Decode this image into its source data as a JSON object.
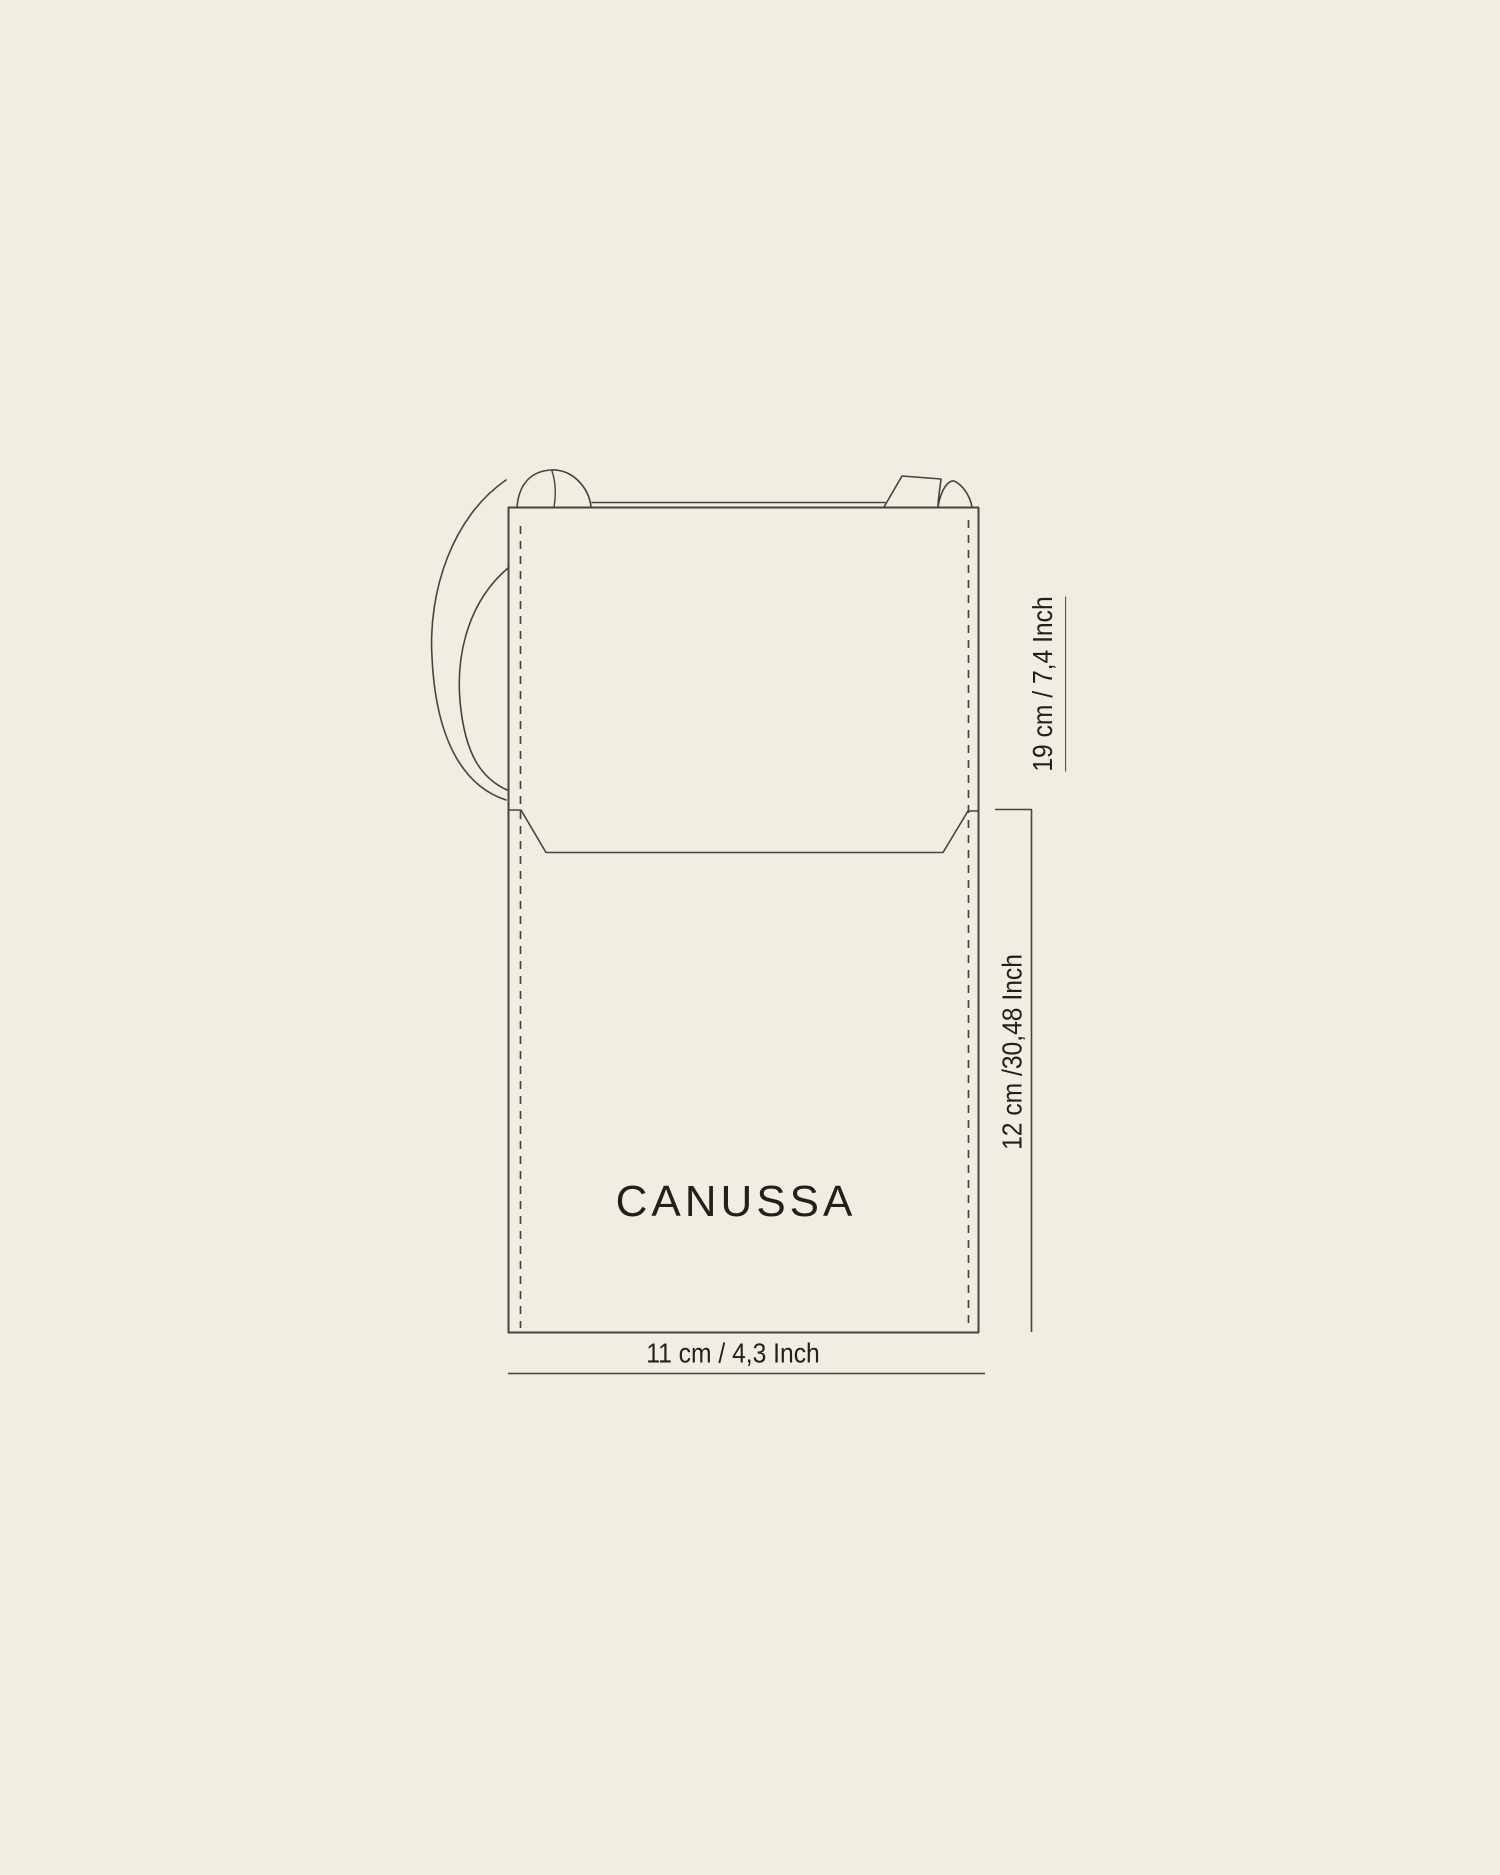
{
  "theme": {
    "background": "#F2EDE2",
    "line_color": "#47443B",
    "text_color": "#21201C"
  },
  "diagram": {
    "type": "product-dimension-diagram",
    "product": "flap crossbody phone bag outline drawing",
    "brand_logo": "CANUSSA",
    "dimensions": {
      "flap_height": {
        "label": "19 cm / 7,4 Inch",
        "orientation": "vertical",
        "underlined": true
      },
      "body_height": {
        "label": "12 cm /30,48 Inch",
        "orientation": "vertical",
        "underlined": false
      },
      "width": {
        "label": "11 cm / 4,3 Inch",
        "orientation": "horizontal",
        "underlined": false
      }
    }
  }
}
